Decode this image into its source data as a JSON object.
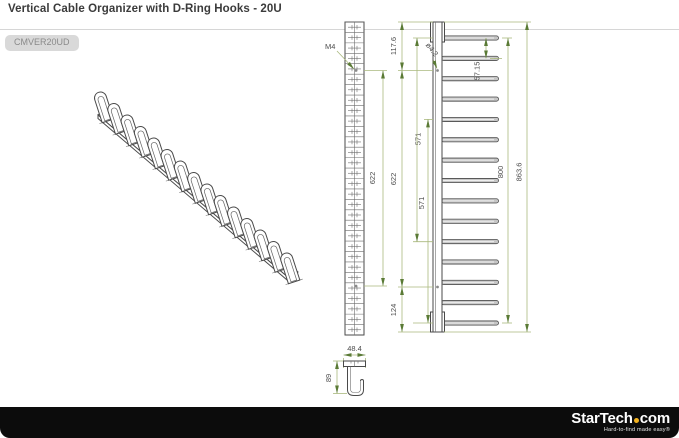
{
  "header": {
    "title": "Vertical Cable Organizer with D-Ring Hooks - 20U",
    "sku": "CMVER20UD"
  },
  "drawing": {
    "labels": {
      "thread": "M4",
      "hole_dia": "ø4.2"
    },
    "dimensions": {
      "front_hole_span": "622",
      "side_top_offset": "117.6",
      "side_hole_span": "622",
      "side_bottom_offset": "124",
      "side_hook_pitch": "57.15",
      "side_span_upper": "571",
      "side_span_lower": "571",
      "side_hook_span": "800",
      "side_total_height": "863.6",
      "section_width": "48.4",
      "section_height": "89"
    },
    "hook_count": 15,
    "iso_hook_count": 15,
    "front_cells": 30
  },
  "footer": {
    "brand_star": "StarTech",
    "brand_tld": "com",
    "tagline": "Hard-to-find made easy®",
    "accent_color": "#f2b11d"
  }
}
